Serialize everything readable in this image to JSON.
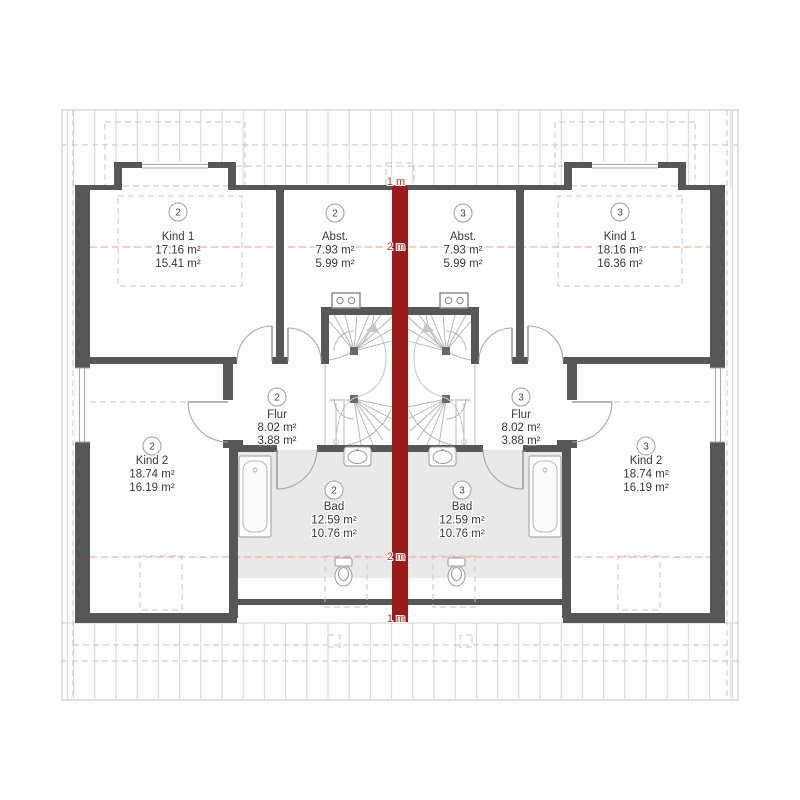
{
  "rooms": {
    "left": {
      "kind1": {
        "unit": "2",
        "name": "Kind 1",
        "area_total": "17.16 m²",
        "area_living": "15.41 m²"
      },
      "abst": {
        "unit": "2",
        "name": "Abst.",
        "area_total": "7.93 m²",
        "area_living": "5.99 m²"
      },
      "flur": {
        "unit": "2",
        "name": "Flur",
        "area_total": "8.02 m²",
        "area_living": "3.88 m²"
      },
      "bad": {
        "unit": "2",
        "name": "Bad",
        "area_total": "12.59 m²",
        "area_living": "10.76 m²"
      },
      "kind2": {
        "unit": "2",
        "name": "Kind 2",
        "area_total": "18.74 m²",
        "area_living": "16.19 m²"
      }
    },
    "right": {
      "kind1": {
        "unit": "3",
        "name": "Kind 1",
        "area_total": "18.16 m²",
        "area_living": "16.36 m²"
      },
      "abst": {
        "unit": "3",
        "name": "Abst.",
        "area_total": "7.93 m²",
        "area_living": "5.99 m²"
      },
      "flur": {
        "unit": "3",
        "name": "Flur",
        "area_total": "8.02 m²",
        "area_living": "3.88 m²"
      },
      "bad": {
        "unit": "3",
        "name": "Bad",
        "area_total": "12.59 m²",
        "area_living": "10.76 m²"
      },
      "kind2": {
        "unit": "3",
        "name": "Kind 2",
        "area_total": "18.74 m²",
        "area_living": "16.19 m²"
      }
    }
  },
  "measurements": {
    "top_height_label": "1 m",
    "upper_contour_label": "2 m",
    "lower_contour_label": "2 m",
    "bottom_height_label": "1 m"
  },
  "icons": {
    "bathtub": "bathtub-icon",
    "washbasin": "washbasin-icon",
    "toilet": "toilet-icon",
    "chimney": "chimney-icon",
    "stairs": "winder-stair",
    "skylight": "skylight-outline",
    "dormer_window": "dormer-window"
  },
  "colors": {
    "party_wall": "#9a1b1b",
    "measure_text": "#c13326",
    "height_contour": "#f0b2a6",
    "wall": "#575757",
    "bath_floor": "#e9e9e9"
  }
}
